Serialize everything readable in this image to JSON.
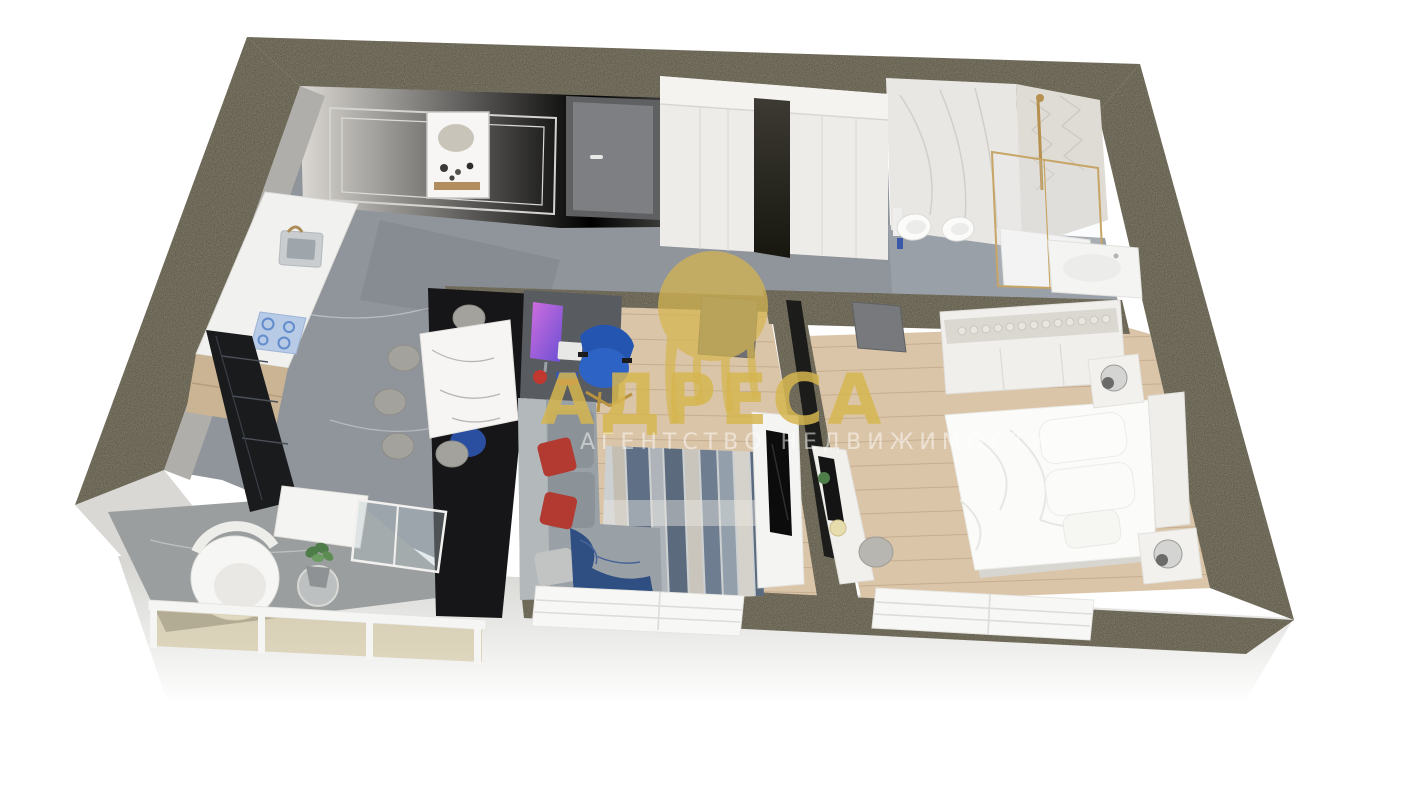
{
  "image": {
    "kind": "3D rendered apartment floor plan (real-estate visualization)",
    "background_color": "#ffffff"
  },
  "watermark": {
    "logo": "gold-arch-emblem",
    "brand": "АДРЕСА",
    "subtitle": "АГЕНТСТВО НЕДВИЖИМОСТИ",
    "brand_color": "#d6b650",
    "subtitle_color": "#ffffff"
  },
  "rooms": [
    "kitchen-dining",
    "entry-hall",
    "living-room",
    "bathroom",
    "bedroom",
    "balcony"
  ],
  "palette": {
    "wall_top": "#4f4937",
    "exterior_wall": "#e0dfdc",
    "interior_wall": "#e9e7e3",
    "marble_floor": "#90959b",
    "bath_floor": "#9aa0a7",
    "wood_floor": "#dbc5a9",
    "accent_black": "#161618",
    "counter_white": "#f1f1ef",
    "fixture_white": "#f4f4f2",
    "bed_white": "#fbfbf9",
    "sofa_gray": "#9aa1a6",
    "pillow_red": "#b23a31",
    "blanket_blue": "#2f4f83",
    "chair_blue": "#2e63c6",
    "gold_fixture": "#c2a268",
    "watermark_gold": "#d6b650"
  }
}
